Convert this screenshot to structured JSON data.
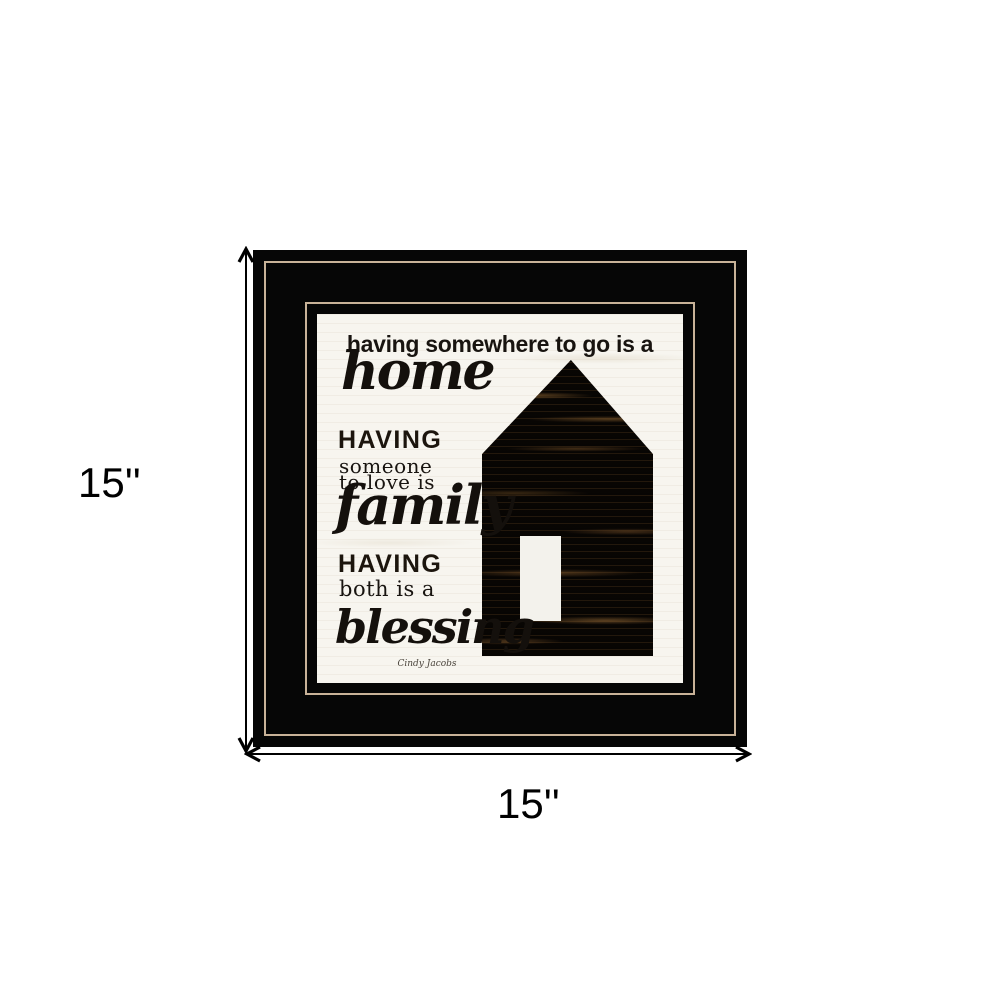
{
  "dimensions": {
    "height_label": "15''",
    "width_label": "15''"
  },
  "artwork": {
    "line1": "having somewhere to go is a",
    "home_word": "home",
    "having_caps_1": "HAVING",
    "someone_line": "someone",
    "to_love_line": "to love is",
    "family_word": "family",
    "having_caps_2": "HAVING",
    "both_line": "both is a",
    "blessing_word": "blessing",
    "signature": "Cindy Jacobs"
  },
  "icons": {
    "height_arrow": "vertical-double-headed-arrow",
    "width_arrow": "horizontal-double-headed-arrow"
  },
  "colors": {
    "page_background": "#ffffff",
    "frame_black": "#060606",
    "pinstripe_tan": "#c8b298",
    "art_background": "#f7f5ef",
    "house_wood_dark": "#120c07",
    "house_wood_highlight": "#8a6134",
    "door_white": "#f3f2ec",
    "text_ink": "#181410",
    "annotation_black": "#000000"
  }
}
